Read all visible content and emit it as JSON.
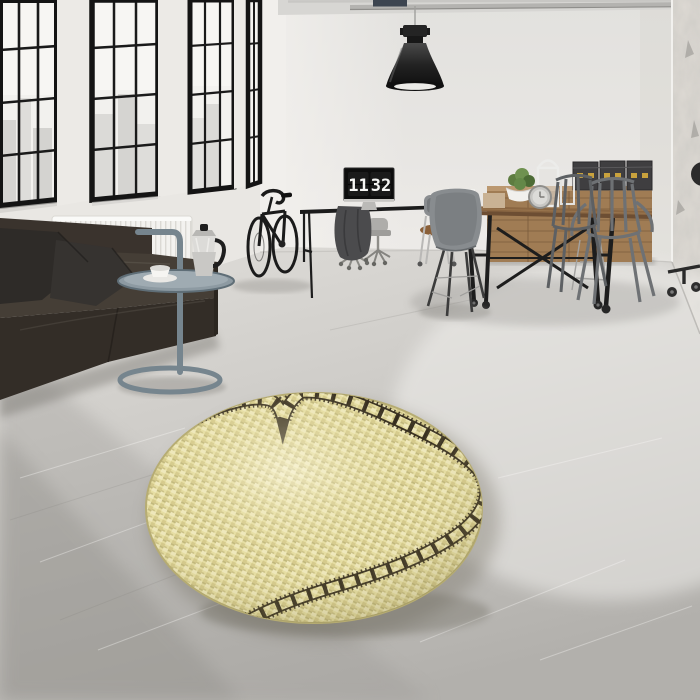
{
  "scene": {
    "type": "interior-photograph",
    "setting": "industrial loft living room with round film-strip heart rug",
    "clock": {
      "hours": "11",
      "minutes": "32"
    },
    "rug": {
      "shape": "round",
      "motif": "film-strip heart",
      "material": "woven"
    },
    "colors": {
      "rug_base": "#e6dea3",
      "rug_light": "#f0e9bf",
      "rug_mid": "#d5ca8c",
      "rug_dark": "#b3a96e",
      "film_strip": "#32291b",
      "sofa_leather": "#453e36",
      "sofa_front": "#332d27",
      "pillow": "#2e2b28",
      "wood_table": "#8a6642",
      "sideboard_wood": "#a07c54",
      "box_dark": "#3f3e40",
      "box_gold": "#c9a23d",
      "steel_table": "#76858e",
      "chair_metal": "#6e7174",
      "wall": "#e7e5e1",
      "window_frame": "#161616",
      "floor_light": "#dcdad6",
      "floor_dark": "#a39f9a",
      "lamp_black": "#1f1f1f"
    },
    "objects": [
      "factory windows with city view",
      "industrial pendant lamp",
      "ceiling pipes",
      "white radiator",
      "dark leather sofa with two cushions",
      "steel loop side table",
      "moka espresso pot",
      "white coffee cup and saucer",
      "black road bicycle",
      "black desk with monitor showing flip clock",
      "grey jacket draped on desk",
      "white office task chairs",
      "wooden sideboard",
      "black storage trunks with brass latches",
      "industrial dining table on casters",
      "metal dining chairs",
      "grey shell chair",
      "wooden seat chair",
      "potted green plant in white bowl",
      "white lantern",
      "chrome table clock",
      "stack of white books",
      "distressed plaster wall",
      "round yellow film-strip heart rug",
      "polished concrete floor"
    ]
  }
}
